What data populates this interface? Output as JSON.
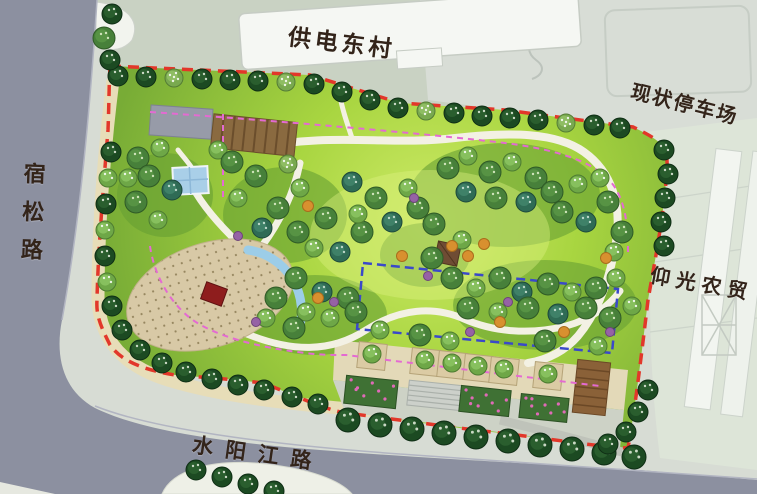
{
  "map": {
    "labels": {
      "village_north": "供电东村",
      "parking_northeast": "现状停车场",
      "road_west": "宿松路",
      "market_east": "仰光农贸",
      "road_south": "水阳江路"
    },
    "colors": {
      "site_boundary_red": "#e2372a",
      "reserved_rect_blue": "#3a49c9",
      "route_pink": "#e46ad2",
      "road_gray": "#8c90a0",
      "lawn_green": "#a8d540",
      "water_blue": "#9ccde8",
      "plaza_tan": "#d8c9a6"
    }
  }
}
